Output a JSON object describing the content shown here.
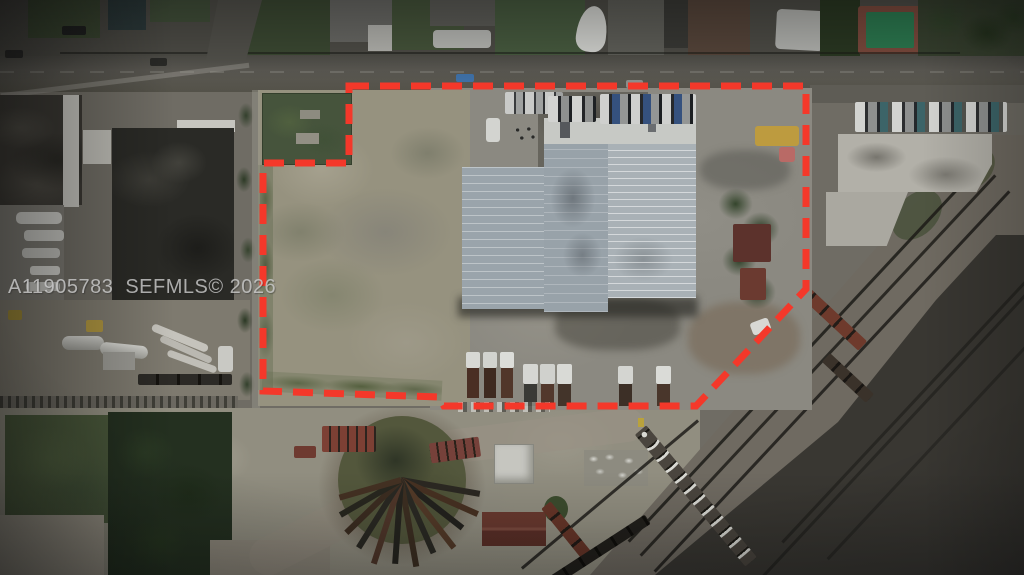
{
  "photo": {
    "watermark": {
      "mls_id": "A11905783",
      "source_tag": "SEFMLS© 2026"
    }
  },
  "colors": {
    "boundary-red": "#f4382a",
    "watermark-gray": "#c9c9c9"
  }
}
